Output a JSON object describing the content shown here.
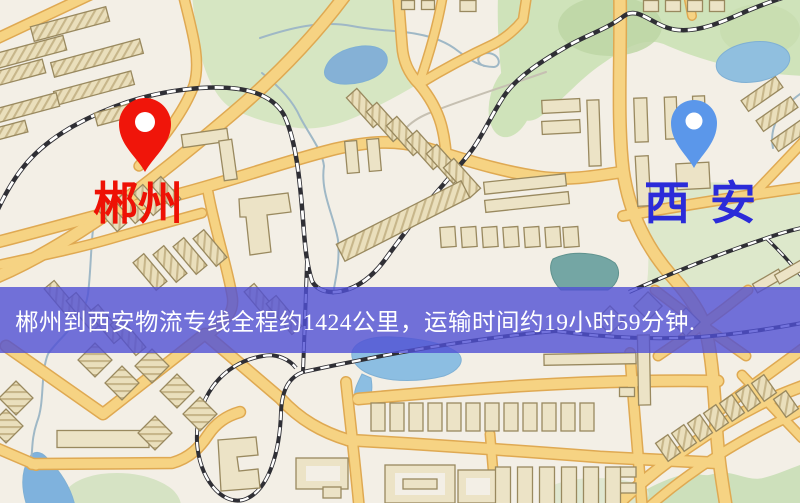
{
  "banner": {
    "text": "郴州到西安物流专线全程约1424公里，运输时间约19小时59分钟."
  },
  "route": {
    "origin": "郴州",
    "destination": "西安",
    "distance_km": "1424",
    "duration": "19小时59分钟"
  },
  "markers": {
    "origin": {
      "name": "郴州",
      "pin_icon": "red-map-pin-icon"
    },
    "destination": {
      "name": "西安",
      "pin_icon": "blue-map-pin-icon"
    }
  },
  "theme": {
    "map-bg": "#f3efe6",
    "road-fill": "#f6d383",
    "road-case": "#dfa952",
    "rail": "#2f2f35",
    "park-green": "#cfe3ba",
    "water-blue": "#8cbee2",
    "building-fill": "#ece3c6",
    "building-stroke": "#99895f",
    "banner-bg": "rgba(80,80,212,0.8)",
    "banner-text": "#ffffff",
    "origin-pin": "#f0150a",
    "origin-label": "#ee1105",
    "dest-pin": "#5b97ea",
    "dest-label": "#2b2bd9"
  }
}
